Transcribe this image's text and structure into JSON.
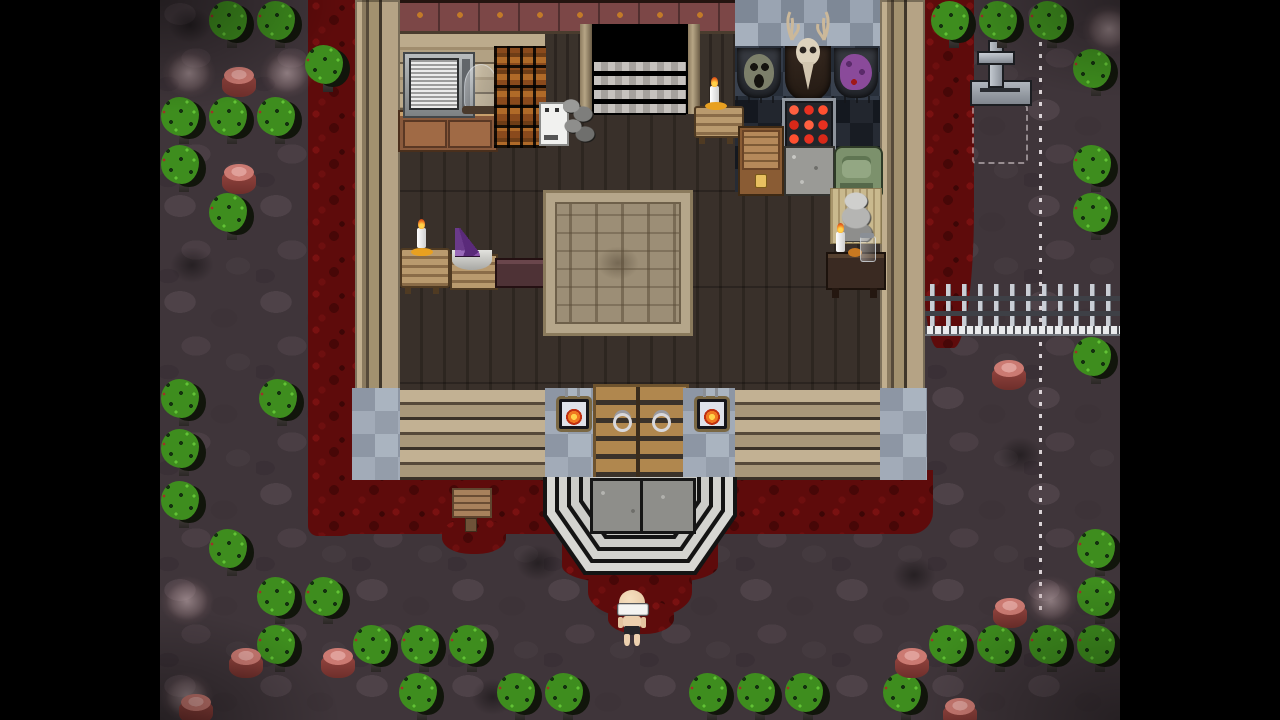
{
  "scene": {
    "description": "Top-down pixel-art horror RPG scene: wooden cabin interior with hunting trophies, blood-soaked yard, graveyard cross, iron fence, dotted trail and a pale bald character standing below the porch steps",
    "letterbox": {
      "color": "#000000",
      "left_width": 160,
      "right_width": 160
    },
    "viewport": {
      "width": 960,
      "height": 720
    }
  },
  "palette": {
    "letterbox": "#000000",
    "ground": "#3f353a",
    "blood": "#5e0b0b",
    "tree": "#3e8d1e",
    "accent": "#c27a28",
    "stone": "#98a0ad",
    "wood_wall": "#b5a385",
    "floor": "#39302a"
  },
  "house": {
    "objects": [
      "static-tv",
      "glass-cloche",
      "crate-shelf",
      "white-appliance",
      "rubble-pile",
      "staircase-up",
      "candle-table",
      "mask-trophy",
      "deer-skull-trophy",
      "purple-trophy",
      "red-display-case",
      "wooden-chest",
      "stone-block",
      "green-machine",
      "gargoyle-statue",
      "writing-desk",
      "candle",
      "glass-jar",
      "crystal-bowl-table",
      "bench",
      "ornate-rug",
      "double-door",
      "wall-lantern-left",
      "wall-lantern-right",
      "porch-steps",
      "wooden-sign"
    ]
  },
  "map": {
    "player": {
      "x": 452,
      "y": 590,
      "facing": "down"
    },
    "scenery": [
      {
        "t": "darkpatch",
        "x": 0,
        "y": 0
      },
      {
        "t": "darkpatch",
        "x": 2,
        "y": 240
      },
      {
        "t": "darkpatch",
        "x": 303,
        "y": 672
      },
      {
        "t": "darkpatch",
        "x": 724,
        "y": 550
      },
      {
        "t": "darkpatch",
        "x": 348,
        "y": 538
      },
      {
        "t": "darkpatch",
        "x": 830,
        "y": 430
      },
      {
        "t": "web",
        "x": 2,
        "y": 48
      },
      {
        "t": "web",
        "x": 100,
        "y": 48
      },
      {
        "t": "web",
        "x": 0,
        "y": 576
      },
      {
        "t": "web",
        "x": 922,
        "y": 4
      },
      {
        "t": "web",
        "x": 864,
        "y": 576
      },
      {
        "t": "web",
        "x": 0,
        "y": 672
      },
      {
        "t": "tree",
        "x": 48,
        "y": 0
      },
      {
        "t": "tree",
        "x": 96,
        "y": 0
      },
      {
        "t": "tree",
        "x": 770,
        "y": 0
      },
      {
        "t": "tree",
        "x": 818,
        "y": 0
      },
      {
        "t": "tree",
        "x": 868,
        "y": 0
      },
      {
        "t": "tree",
        "x": 144,
        "y": 44
      },
      {
        "t": "tree",
        "x": 912,
        "y": 48
      },
      {
        "t": "tree",
        "x": 0,
        "y": 96
      },
      {
        "t": "tree",
        "x": 48,
        "y": 96
      },
      {
        "t": "tree",
        "x": 96,
        "y": 96
      },
      {
        "t": "tree",
        "x": 0,
        "y": 144
      },
      {
        "t": "tree",
        "x": 912,
        "y": 144
      },
      {
        "t": "tree",
        "x": 48,
        "y": 192
      },
      {
        "t": "tree",
        "x": 912,
        "y": 192
      },
      {
        "t": "tree",
        "x": 912,
        "y": 336
      },
      {
        "t": "tree",
        "x": 0,
        "y": 378
      },
      {
        "t": "tree",
        "x": 98,
        "y": 378
      },
      {
        "t": "tree",
        "x": 0,
        "y": 428
      },
      {
        "t": "tree",
        "x": 0,
        "y": 480
      },
      {
        "t": "tree",
        "x": 48,
        "y": 528
      },
      {
        "t": "tree",
        "x": 916,
        "y": 528
      },
      {
        "t": "tree",
        "x": 96,
        "y": 576
      },
      {
        "t": "tree",
        "x": 144,
        "y": 576
      },
      {
        "t": "tree",
        "x": 916,
        "y": 576
      },
      {
        "t": "tree",
        "x": 96,
        "y": 624
      },
      {
        "t": "tree",
        "x": 192,
        "y": 624
      },
      {
        "t": "tree",
        "x": 240,
        "y": 624
      },
      {
        "t": "tree",
        "x": 288,
        "y": 624
      },
      {
        "t": "tree",
        "x": 768,
        "y": 624
      },
      {
        "t": "tree",
        "x": 816,
        "y": 624
      },
      {
        "t": "tree",
        "x": 868,
        "y": 624
      },
      {
        "t": "tree",
        "x": 916,
        "y": 624
      },
      {
        "t": "tree",
        "x": 238,
        "y": 672
      },
      {
        "t": "tree",
        "x": 336,
        "y": 672
      },
      {
        "t": "tree",
        "x": 384,
        "y": 672
      },
      {
        "t": "tree",
        "x": 528,
        "y": 672
      },
      {
        "t": "tree",
        "x": 576,
        "y": 672
      },
      {
        "t": "tree",
        "x": 624,
        "y": 672
      },
      {
        "t": "tree",
        "x": 722,
        "y": 672
      },
      {
        "t": "stump",
        "x": 55,
        "y": 55
      },
      {
        "t": "stump",
        "x": 55,
        "y": 152
      },
      {
        "t": "stump",
        "x": 62,
        "y": 636
      },
      {
        "t": "stump",
        "x": 154,
        "y": 636
      },
      {
        "t": "stump",
        "x": 12,
        "y": 682
      },
      {
        "t": "stump",
        "x": 825,
        "y": 348
      },
      {
        "t": "stump",
        "x": 826,
        "y": 586
      },
      {
        "t": "stump",
        "x": 728,
        "y": 636
      },
      {
        "t": "stump",
        "x": 776,
        "y": 686
      }
    ]
  }
}
